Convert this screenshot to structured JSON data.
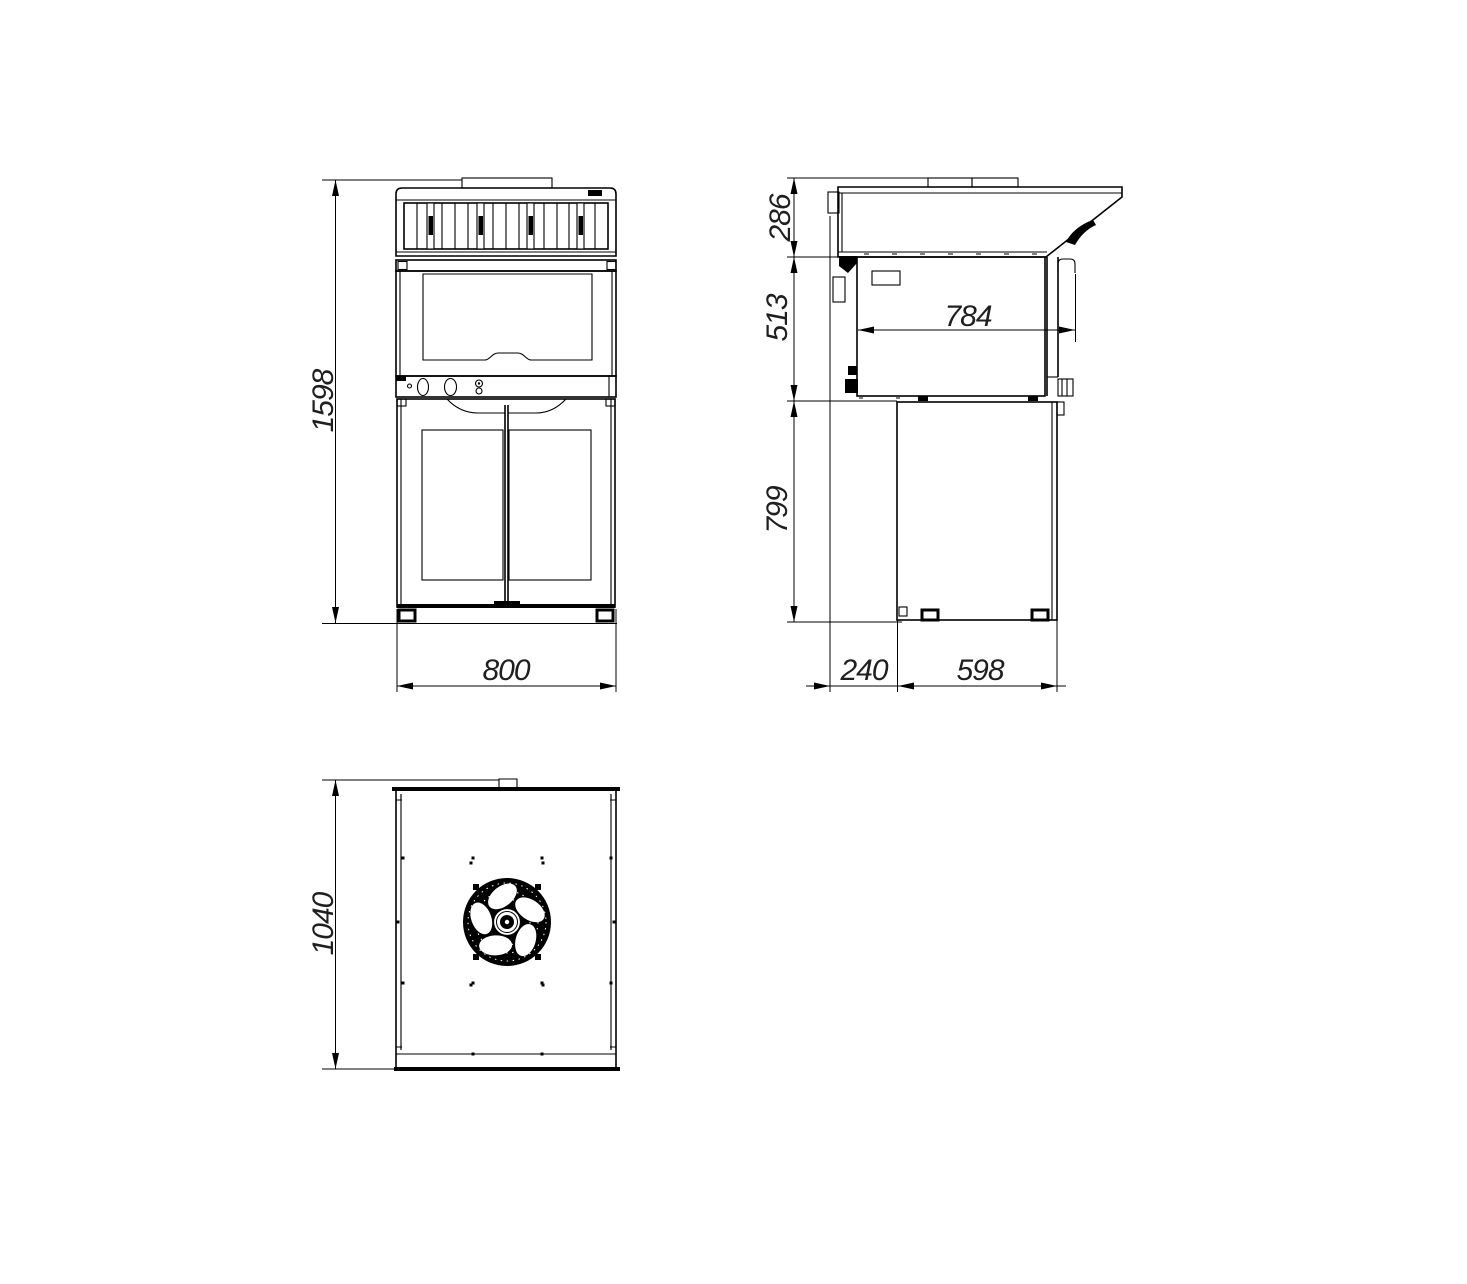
{
  "colors": {
    "background": "#ffffff",
    "line": "#000000",
    "dimension_text": "#1f1f1f"
  },
  "views": {
    "front": {
      "dimensions": {
        "overall_height_mm": "1598",
        "overall_width_mm": "800"
      }
    },
    "side": {
      "dimensions": {
        "hood_height_mm": "286",
        "oven_body_height_mm": "513",
        "stand_height_mm": "799",
        "body_depth_mm": "784",
        "rear_clearance_mm": "240",
        "stand_depth_mm": "598"
      }
    },
    "top": {
      "dimensions": {
        "overall_depth_mm": "1040"
      }
    }
  }
}
